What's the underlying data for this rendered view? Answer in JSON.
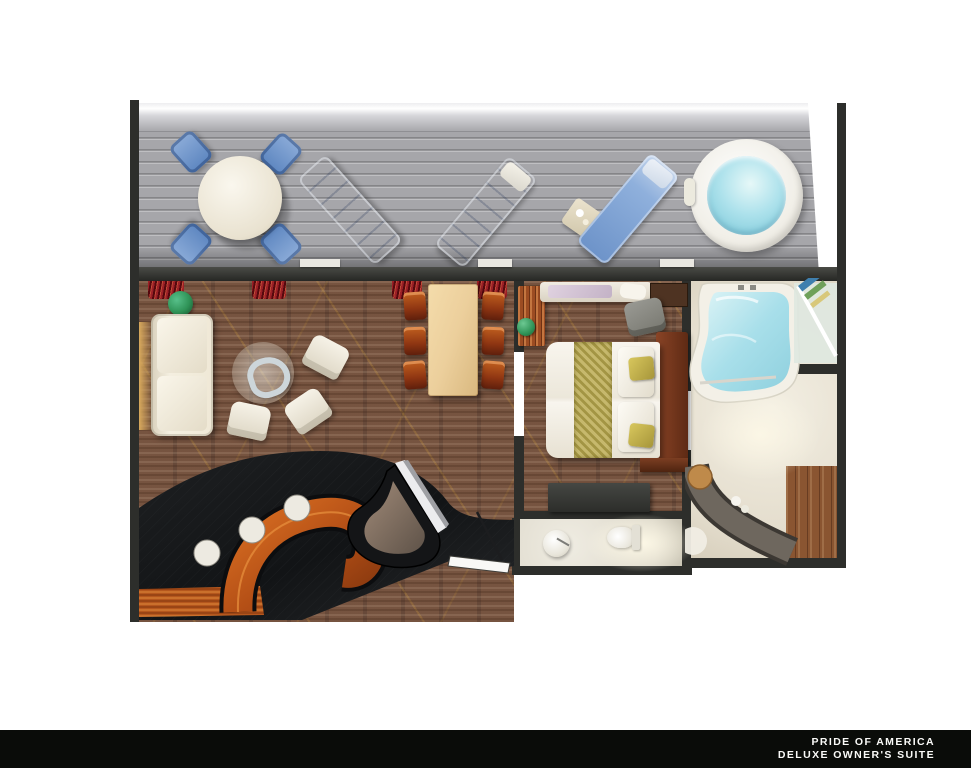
{
  "caption": {
    "line1": "PRIDE OF AMERICA",
    "line2": "DELUXE OWNER'S SUITE"
  },
  "colors": {
    "page_background": "#ffffff",
    "caption_bar": "#0a0c09",
    "caption_text": "#fafaf8",
    "wall": "#2d2e2b",
    "balcony_deck": "#a6a6aa",
    "balcony_railing": "#d6d6da",
    "outdoor_furniture_blue": "#6f94cb",
    "hot_tub_water": "#9edbe7",
    "carpet_brown": "#73513f",
    "carpet_scroll_gold": "#ba8c3c",
    "lounge_floor_black": "#17191b",
    "bar_counter_orange": "#c25c1d",
    "sofa_cream": "#f0e8d6",
    "dining_table_wood": "#eccf9c",
    "dining_chair_wood": "#a8441e",
    "bed_linen_white": "#f5f2ea",
    "bed_runner_gold": "#b3a44e",
    "bed_headboard_wood": "#743a22",
    "bathroom_floor": "#e9e2d4",
    "bathtub_water": "#aadfe9",
    "wood_floor_brown": "#8a5531"
  }
}
